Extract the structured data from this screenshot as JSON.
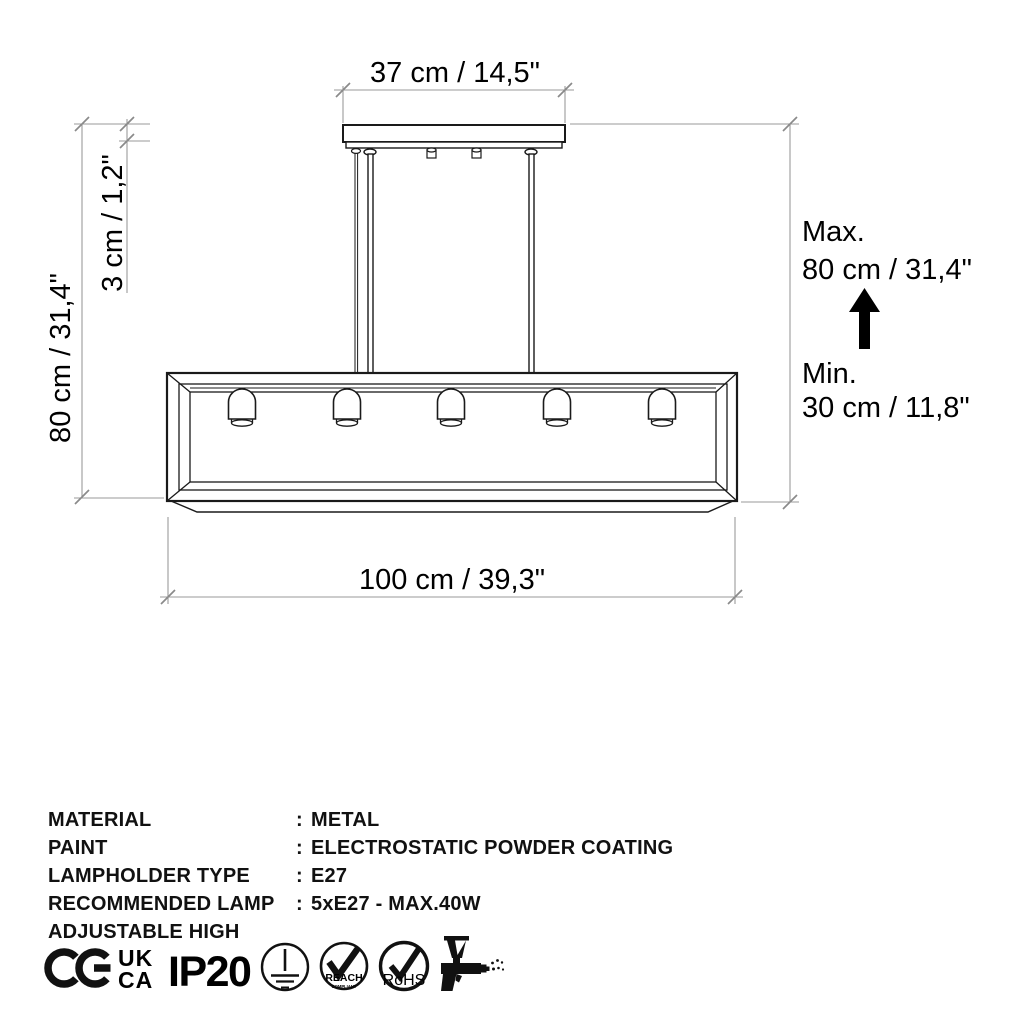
{
  "diagram": {
    "dim_top": "37 cm / 14,5\"",
    "dim_height": "80 cm / 31,4\"",
    "dim_canopy_thickness": "3 cm / 1,2\"",
    "dim_width": "100 cm / 39,3\"",
    "max_label": "Max.",
    "max_value": "80 cm / 31,4\"",
    "min_label": "Min.",
    "min_value": "30 cm / 11,8\"",
    "lamp_socket_count": 5
  },
  "specs": {
    "rows": [
      {
        "label": "MATERIAL",
        "sep": ":",
        "value": "METAL"
      },
      {
        "label": "PAINT",
        "sep": ":",
        "value": "ELECTROSTATIC POWDER COATING"
      },
      {
        "label": "LAMPHOLDER TYPE",
        "sep": ":",
        "value": "E27"
      },
      {
        "label": "RECOMMENDED LAMP",
        "sep": ":",
        "value": "5xE27 - MAX.40W"
      },
      {
        "label": "ADJUSTABLE HIGH",
        "sep": "",
        "value": ""
      }
    ]
  },
  "certifications": {
    "ce_label": "CE",
    "ukca_top": "UK",
    "ukca_bottom": "CA",
    "ip_rating": "IP20",
    "reach_text": "REACH",
    "reach_subtext": "COMPLIANT",
    "rohs_text": "RoHS"
  },
  "colors": {
    "drawing_line": "#1a1a1a",
    "dimension_line": "#9a9a9a",
    "text": "#000000",
    "background": "#ffffff"
  }
}
